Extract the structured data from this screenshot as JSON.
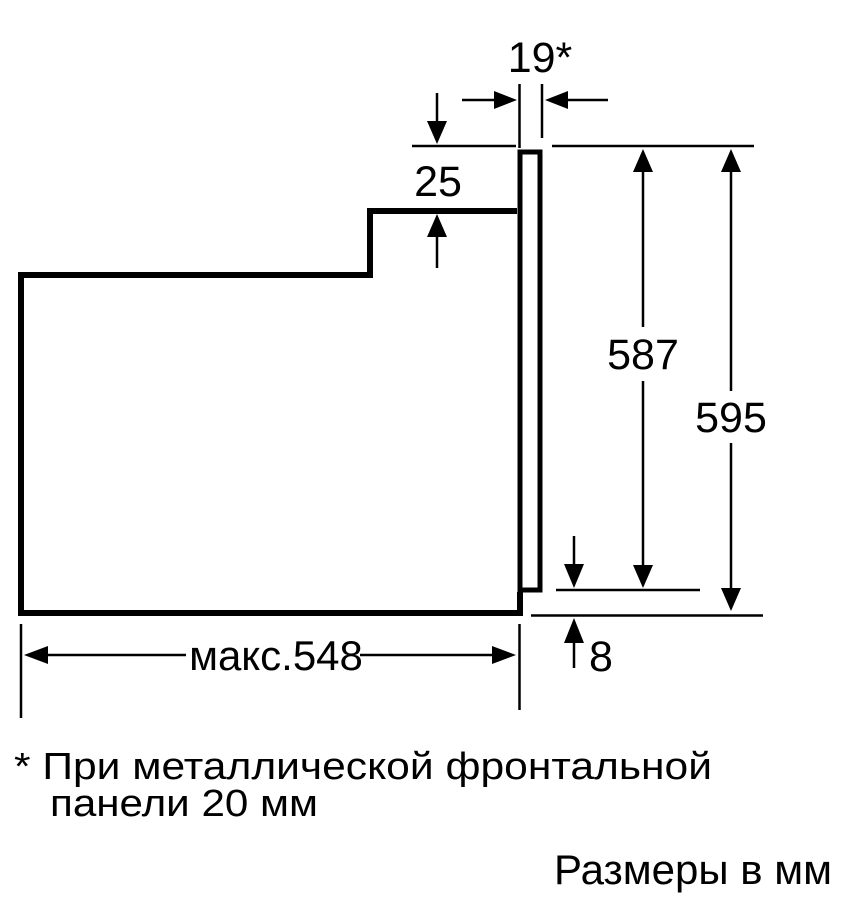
{
  "diagram": {
    "dimensions": {
      "front_panel_thickness": "19*",
      "top_step": "25",
      "panel_height": "587",
      "total_height": "595",
      "bottom_offset": "8",
      "max_depth": "макс.548"
    },
    "footnote": {
      "line1": "* При металлической фронтальной",
      "line2": "панели 20 мм"
    },
    "units_note": "Размеры в мм",
    "colors": {
      "line": "#000000",
      "background": "#ffffff"
    }
  }
}
